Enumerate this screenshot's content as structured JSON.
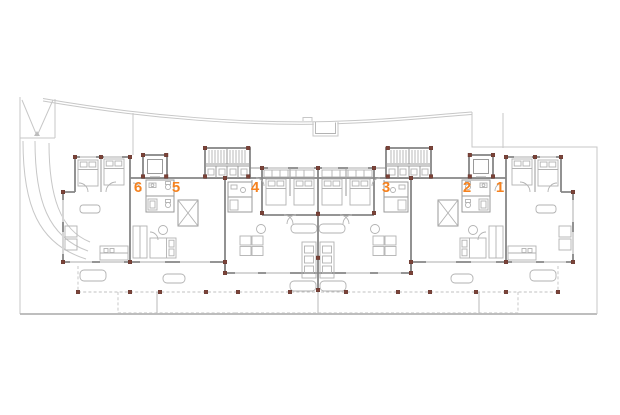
{
  "colors": {
    "accent": "#f5821f",
    "walls": "#868686",
    "thin_lines": "#b2b2b2",
    "site_lines": "#c7c7c7",
    "column_markers": "#7c4338",
    "background": "#ffffff"
  },
  "plan": {
    "units": [
      {
        "label": "6"
      },
      {
        "label": "5"
      },
      {
        "label": "4"
      },
      {
        "label": "3"
      },
      {
        "label": "2"
      },
      {
        "label": "1"
      }
    ]
  }
}
